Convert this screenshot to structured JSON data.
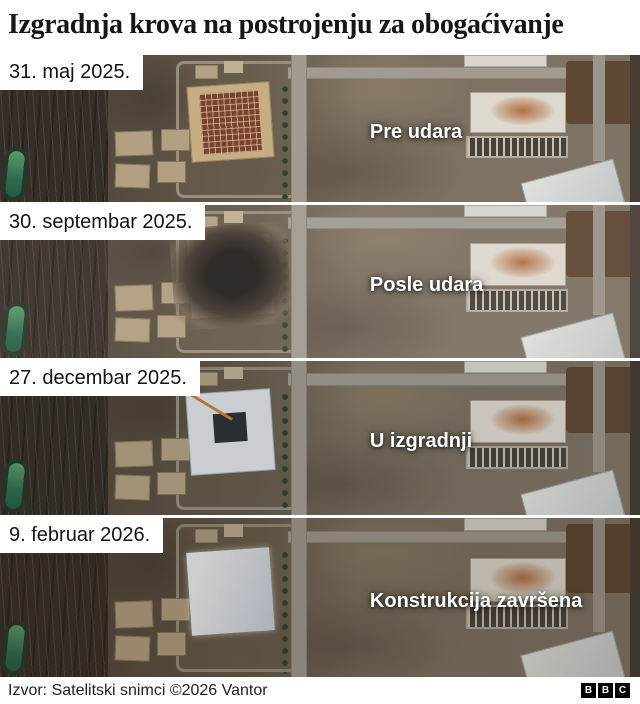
{
  "title": "Izgradnja krova na postrojenju za obogaćivanje",
  "panels": [
    {
      "date": "31. maj 2025.",
      "annotation": "Pre udara"
    },
    {
      "date": "30. septembar 2025.",
      "annotation": "Posle udara"
    },
    {
      "date": "27. decembar 2025.",
      "annotation": "U izgradnji"
    },
    {
      "date": "9. februar 2026.",
      "annotation": "Konstrukcija završena"
    }
  ],
  "footer": {
    "source": "Izvor: Satelitski snimci ©2026 Vantor",
    "logo": [
      "B",
      "B",
      "C"
    ]
  },
  "colors": {
    "page_bg": "#ffffff",
    "title_text": "#161616",
    "annotation_text": "#ffffff",
    "date_label_bg": "#ffffff",
    "pond_green": "#3f7c58",
    "roof_before_tan": "#c6ad84",
    "roof_grid_red": "#7a4230",
    "rubble_dark": "#2a2622",
    "roof_new_white": "#e8edf2",
    "rust_stain_orange": "#a85c28",
    "bbc_block_bg": "#000000"
  }
}
